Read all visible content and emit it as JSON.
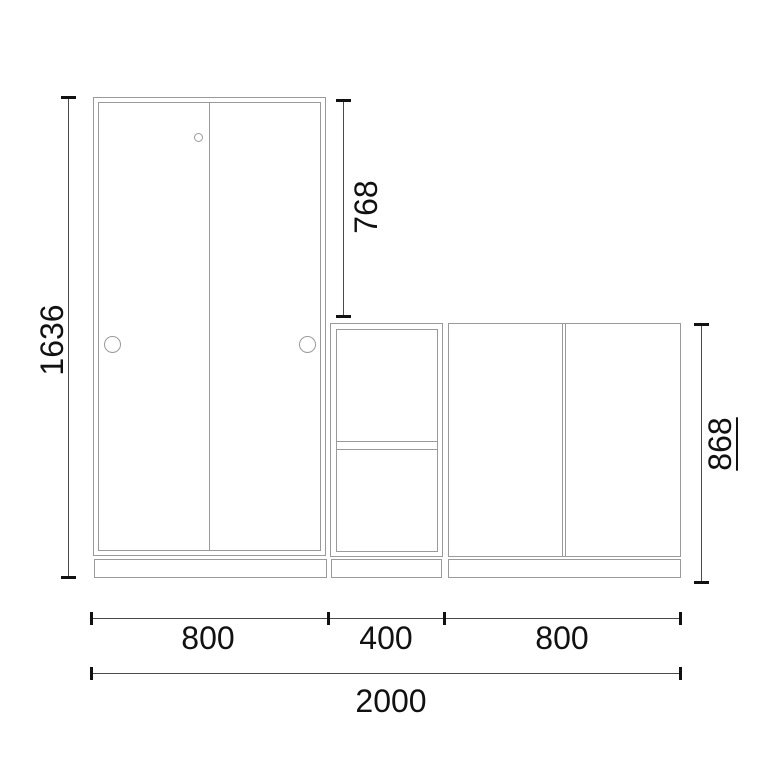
{
  "diagram": {
    "type": "furniture-dimension-drawing",
    "units": "mm",
    "pieces": [
      "wardrobe",
      "open-shelf-unit",
      "two-door-cabinet"
    ]
  },
  "colors": {
    "background": "#ffffff",
    "furniture_outline": "#9a9a9a",
    "dimension_line": "#4a4a4a",
    "dimension_text": "#111111"
  },
  "dimensions": {
    "wardrobe_height": "1636",
    "upper_section_height": "768",
    "base_units_height": "868",
    "wardrobe_width": "800",
    "shelf_unit_width": "400",
    "cabinet_width": "800",
    "total_width": "2000"
  }
}
